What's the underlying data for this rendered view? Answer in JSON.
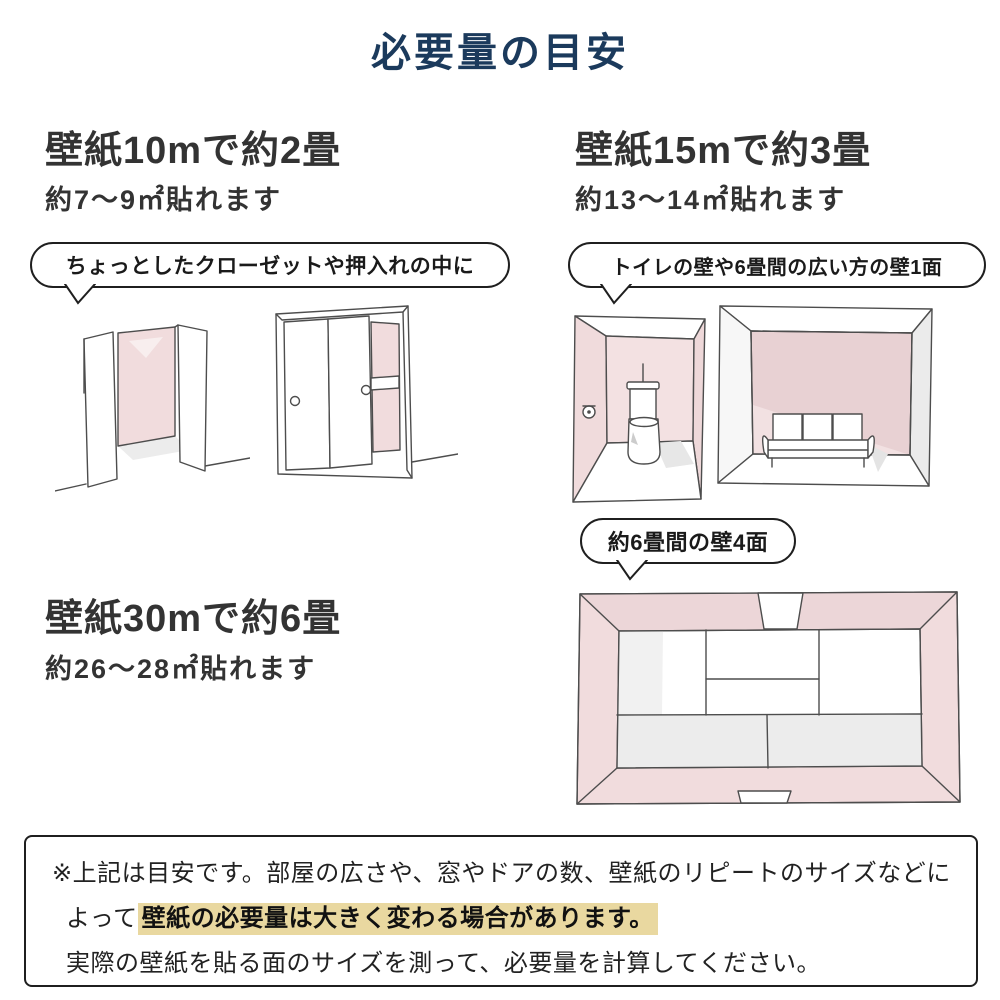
{
  "title": "必要量の目安",
  "colors": {
    "title_navy": "#1b3a5c",
    "heading_gray": "#333333",
    "bubble_border": "#1f1f1f",
    "wall_pink": "#f1dcdd",
    "wall_pink_dark": "#e9d2d4",
    "shadow_gray": "#ececec",
    "sketch_line": "#4d4d4d",
    "highlight_tan": "#e9d8a0"
  },
  "sections": {
    "s10m": {
      "heading": "壁紙10mで約2畳",
      "subtitle": "約7〜9㎡貼れます",
      "bubble": "ちょっとしたクローゼットや押入れの中に"
    },
    "s15m": {
      "heading": "壁紙15mで約3畳",
      "subtitle": "約13〜14㎡貼れます",
      "bubble": "トイレの壁や6畳間の広い方の壁1面"
    },
    "s30m": {
      "heading": "壁紙30mで約6畳",
      "subtitle": "約26〜28㎡貼れます",
      "bubble": "約6畳間の壁4面"
    }
  },
  "illustrations": {
    "closet_open": "open-closet-sketch",
    "closet_sliding": "sliding-door-closet-sketch",
    "toilet_room": "toilet-room-sketch",
    "sofa_room": "six-tatami-room-wide-wall-sketch",
    "tatami_room": "six-tatami-room-four-walls-top-view-sketch"
  },
  "note": {
    "line1": "※上記は目安です。部屋の広さや、窓やドアの数、壁紙のリピートのサイズなどに",
    "line2_prefix": "よって",
    "line2_highlight": "壁紙の必要量は大きく変わる場合があります。",
    "line3": "実際の壁紙を貼る面のサイズを測って、必要量を計算してください。"
  }
}
